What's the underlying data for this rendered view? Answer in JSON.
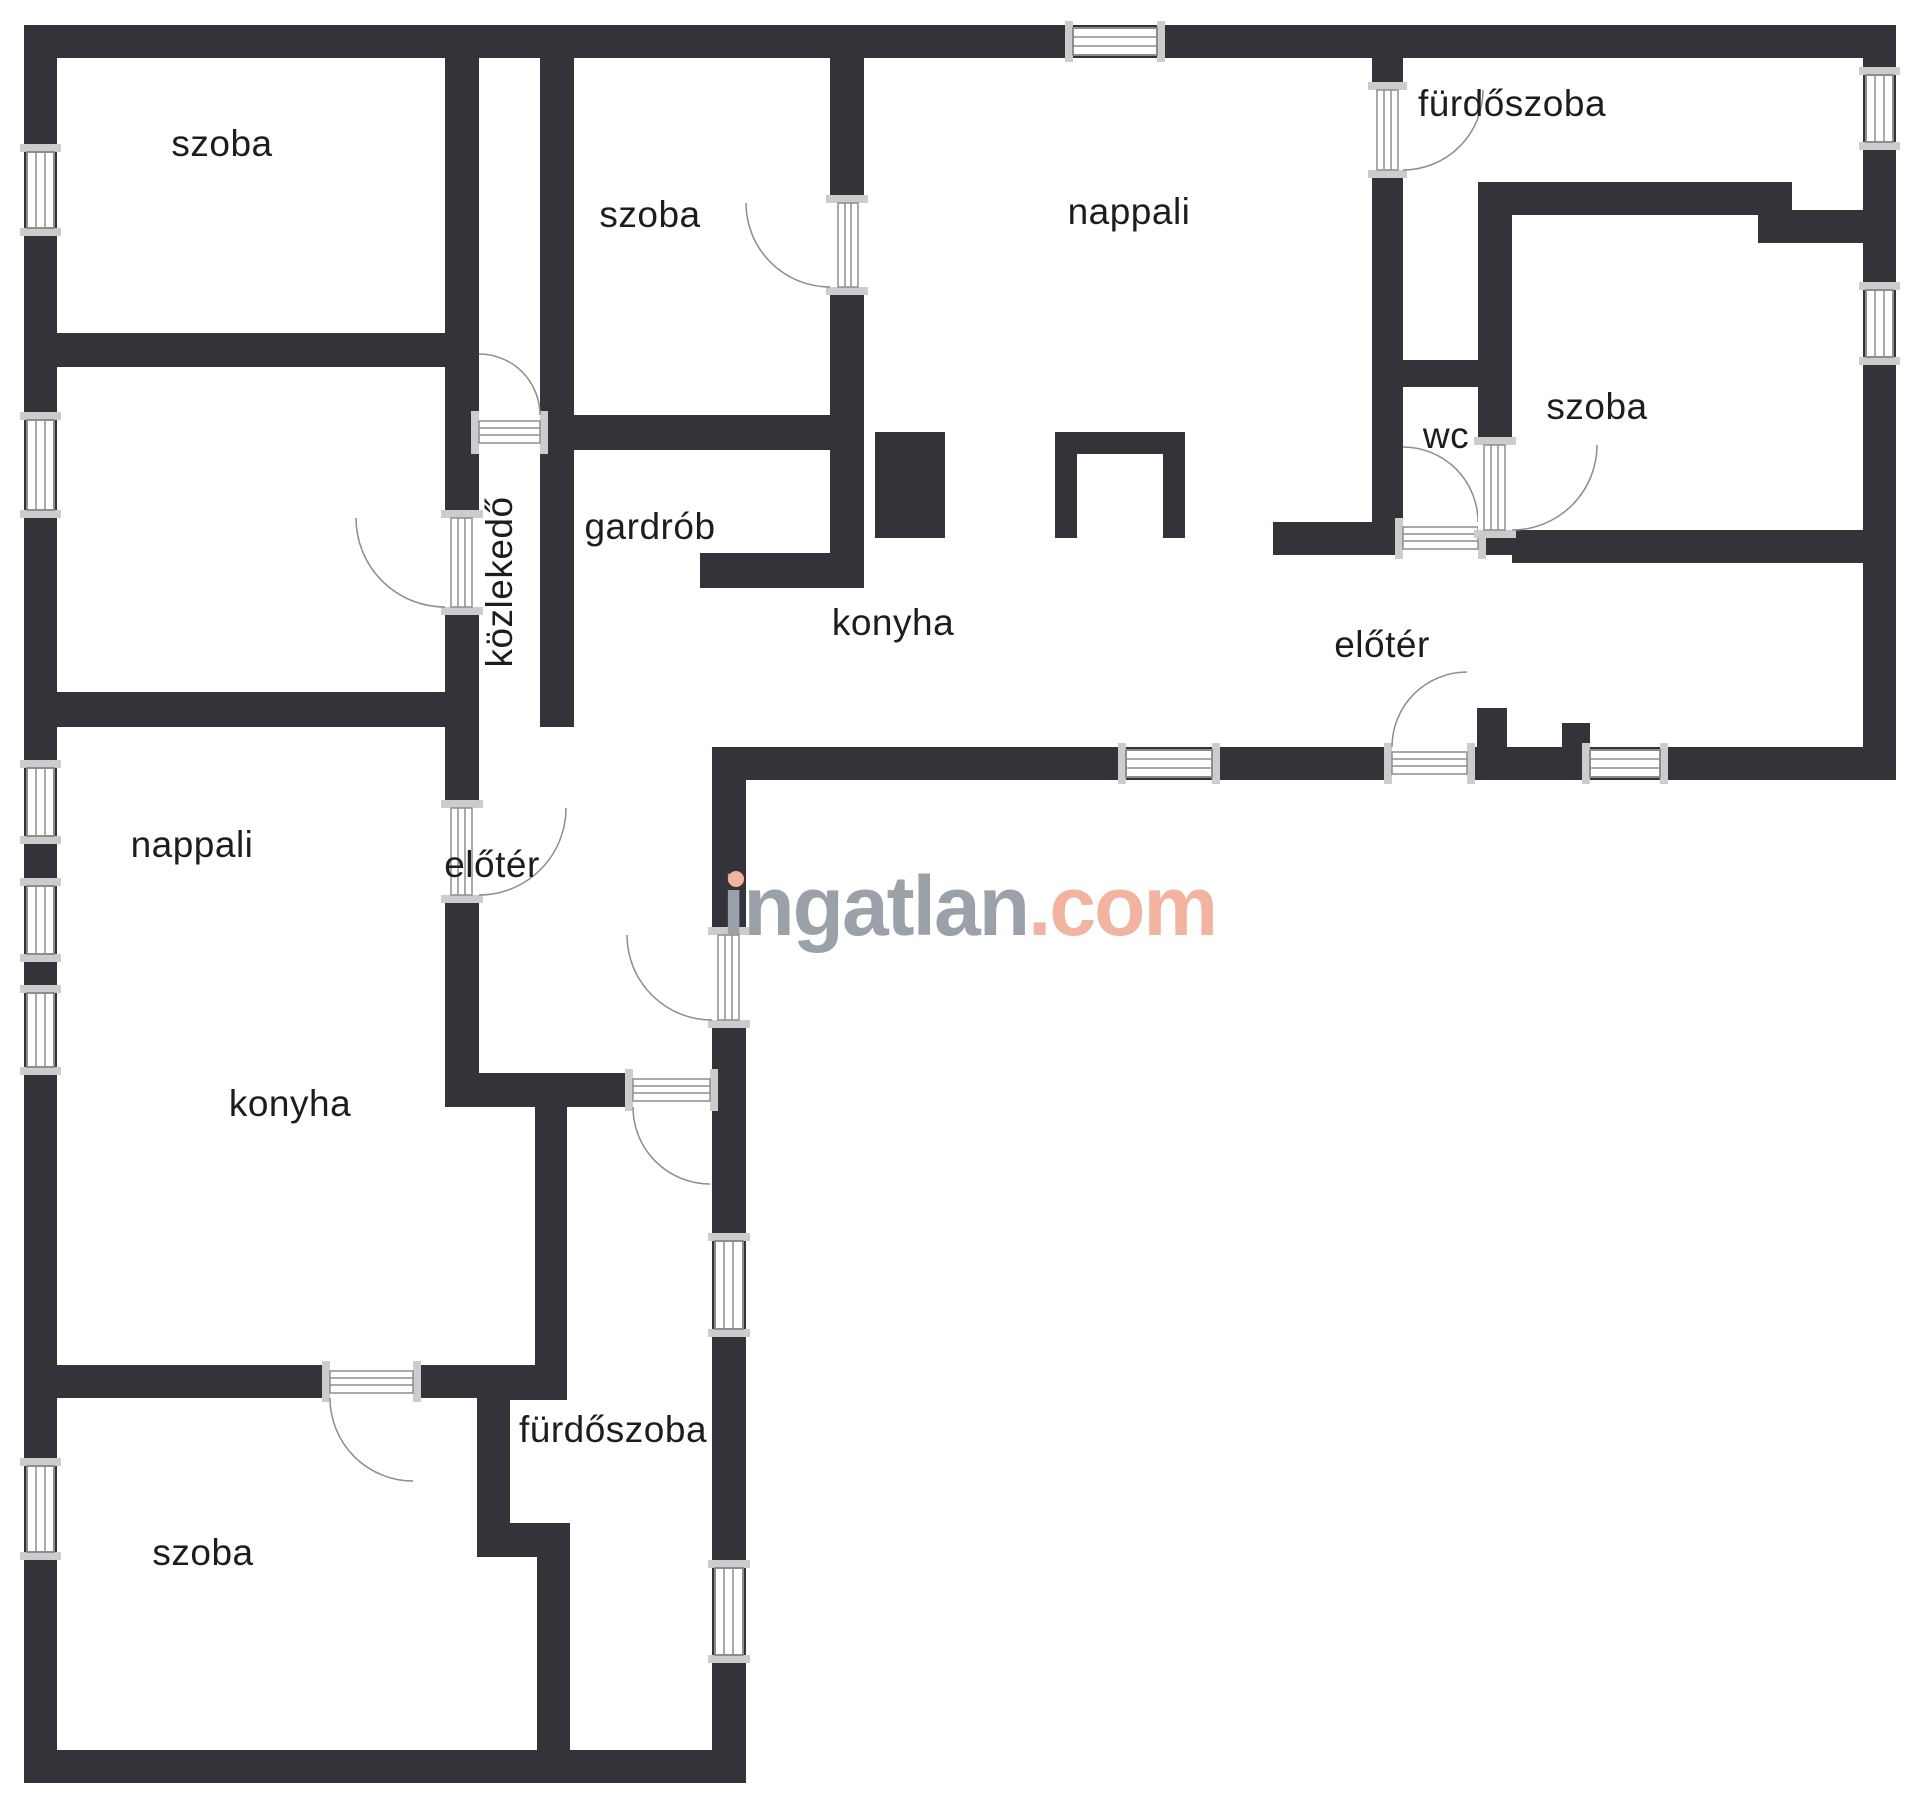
{
  "theme": {
    "wall": "#343339",
    "outline": "#8d8d8d",
    "jamb": "#cccccc",
    "label": "#1d1d1f",
    "wmgray": "#9ba1a8",
    "wmaccent": "#f2b3a0",
    "bg": "#ffffff"
  },
  "watermark": {
    "brand": "ingatlan",
    "tld": ".com"
  },
  "rooms": [
    {
      "id": "bedroom-top-left",
      "label": "szoba"
    },
    {
      "id": "bedroom-top-middle",
      "label": "szoba"
    },
    {
      "id": "living-room-top",
      "label": "nappali"
    },
    {
      "id": "bathroom-top",
      "label": "fürdőszoba"
    },
    {
      "id": "wc",
      "label": "wc"
    },
    {
      "id": "bedroom-right",
      "label": "szoba"
    },
    {
      "id": "hallway",
      "label": "közlekedő"
    },
    {
      "id": "wardrobe",
      "label": "gardrób"
    },
    {
      "id": "kitchen-top",
      "label": "konyha"
    },
    {
      "id": "foyer-top",
      "label": "előtér"
    },
    {
      "id": "living-room-lower",
      "label": "nappali"
    },
    {
      "id": "foyer-lower",
      "label": "előtér"
    },
    {
      "id": "kitchen-lower",
      "label": "konyha"
    },
    {
      "id": "bathroom-lower",
      "label": "fürdőszoba"
    },
    {
      "id": "bedroom-bottom",
      "label": "szoba"
    }
  ]
}
